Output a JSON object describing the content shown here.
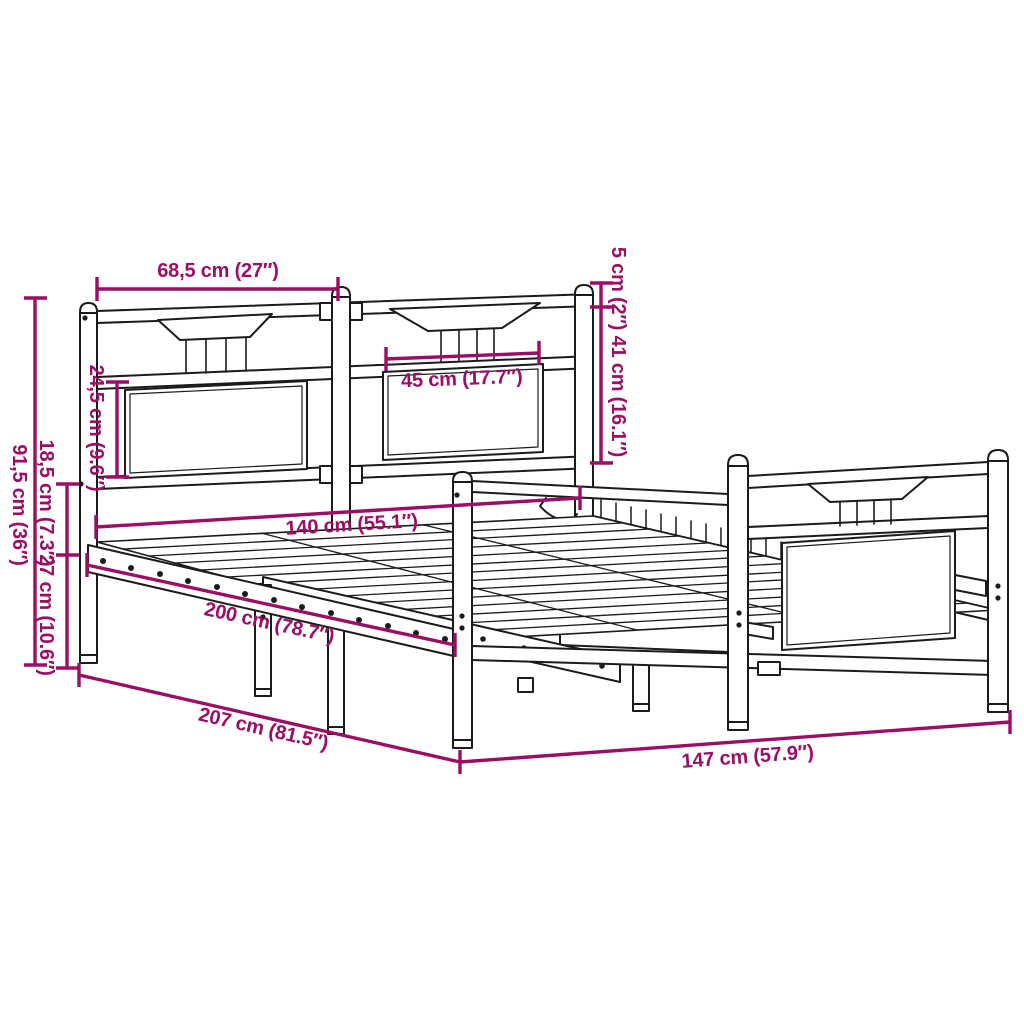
{
  "diagram": {
    "title": "Bed frame dimension diagram",
    "product": "metal bed frame with headboard and footboard",
    "style": "black line art with magenta dimension annotations",
    "colors": {
      "dimension": "#9B0E63",
      "line": "#1B1B1B",
      "background": "#FFFFFF"
    },
    "dims": {
      "headboard_section_width": {
        "label": "68,5 cm (27″)"
      },
      "panel_width": {
        "label": "45 cm (17.7″)"
      },
      "post_cap_and_upper_height": {
        "label": "5 cm (2″) 41 cm (16.1″)"
      },
      "headboard_panel_height": {
        "label": "24,5 cm (9.6″)"
      },
      "headboard_height": {
        "label": "91,5 cm (36″)"
      },
      "rail_height": {
        "label": "18,5 cm (7.3″)"
      },
      "clearance_height": {
        "label": "27 cm (10.6″)"
      },
      "mattress_width": {
        "label": "140 cm (55.1″)"
      },
      "mattress_length": {
        "label": "200 cm (78.7″)"
      },
      "frame_length": {
        "label": "207 cm (81.5″)"
      },
      "frame_width": {
        "label": "147 cm (57.9″)"
      }
    }
  }
}
